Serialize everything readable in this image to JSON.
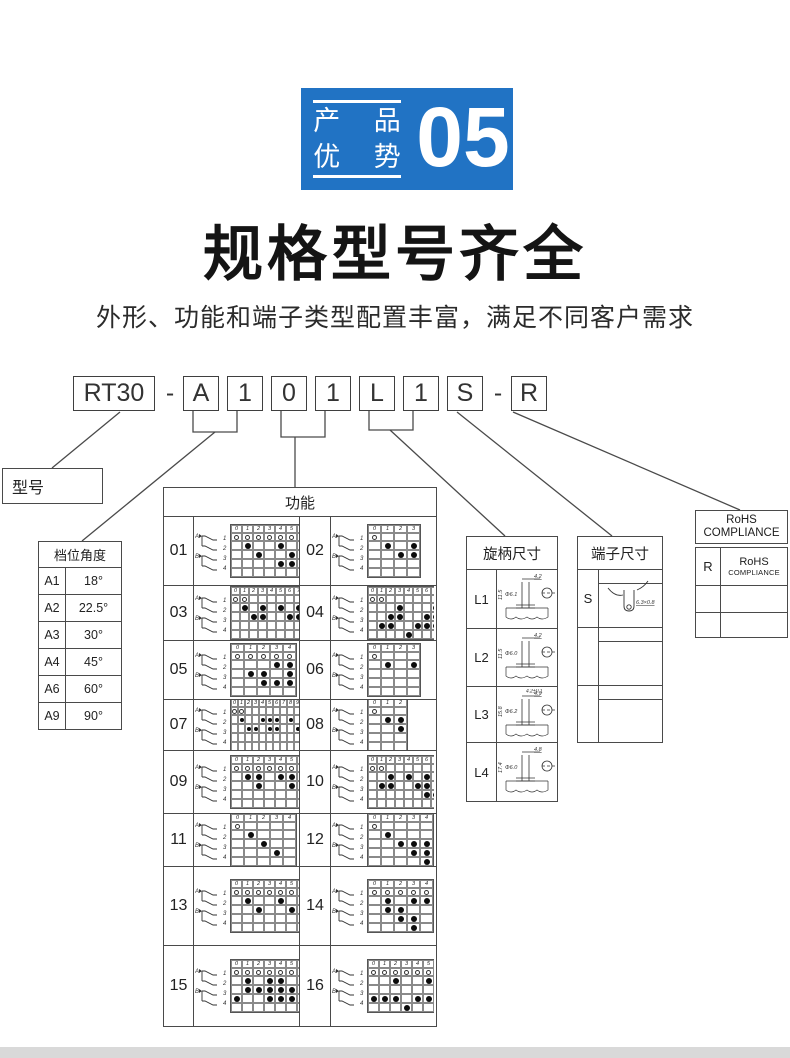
{
  "colors": {
    "accent_blue": "#2173c4",
    "line": "#4a4a4a",
    "footer_gray": "#d9d9d9"
  },
  "badge": {
    "line1": "产 品",
    "line2": "优 势",
    "number": "05"
  },
  "title": "规格型号齐全",
  "subtitle": "外形、功能和端子类型配置丰富，满足不同客户需求",
  "model_code": {
    "segments": [
      "RT30",
      "-",
      "A",
      "1",
      "0",
      "1",
      "L",
      "1",
      "S",
      "-",
      "R"
    ]
  },
  "model_label": "型号",
  "angle_table": {
    "title": "档位角度",
    "rows": [
      [
        "A1",
        "18°"
      ],
      [
        "A2",
        "22.5°"
      ],
      [
        "A3",
        "30°"
      ],
      [
        "A4",
        "45°"
      ],
      [
        "A6",
        "60°"
      ],
      [
        "A9",
        "90°"
      ]
    ]
  },
  "function_table": {
    "title": "功能",
    "cells": [
      {
        "no": "01",
        "cols": 7,
        "circles": [
          0,
          1,
          2,
          3,
          4,
          5,
          6
        ],
        "dots": [
          [
            1,
            1
          ],
          [
            1,
            4
          ],
          [
            2,
            2
          ],
          [
            2,
            5
          ],
          [
            3,
            4
          ],
          [
            3,
            5
          ]
        ]
      },
      {
        "no": "02",
        "cols": 4,
        "circles": [
          0
        ],
        "dots": [
          [
            1,
            1
          ],
          [
            1,
            3
          ],
          [
            2,
            2
          ],
          [
            2,
            3
          ]
        ]
      },
      {
        "no": "03",
        "cols": 9,
        "circles": [
          0,
          1
        ],
        "dots": [
          [
            1,
            1
          ],
          [
            1,
            3
          ],
          [
            1,
            5
          ],
          [
            1,
            7
          ],
          [
            2,
            2
          ],
          [
            2,
            3
          ],
          [
            2,
            6
          ],
          [
            2,
            7
          ]
        ]
      },
      {
        "no": "04",
        "cols": 9,
        "circles": [
          0,
          1
        ],
        "dots": [
          [
            1,
            3
          ],
          [
            1,
            7
          ],
          [
            2,
            2
          ],
          [
            2,
            3
          ],
          [
            2,
            6
          ],
          [
            2,
            7
          ],
          [
            3,
            1
          ],
          [
            3,
            2
          ],
          [
            3,
            5
          ],
          [
            3,
            6
          ],
          [
            3,
            7
          ],
          [
            4,
            4
          ]
        ]
      },
      {
        "no": "05",
        "cols": 5,
        "circles": [
          0,
          1,
          2,
          3,
          4
        ],
        "dots": [
          [
            1,
            3
          ],
          [
            1,
            4
          ],
          [
            2,
            1
          ],
          [
            2,
            2
          ],
          [
            2,
            4
          ],
          [
            3,
            2
          ],
          [
            3,
            3
          ],
          [
            3,
            4
          ]
        ]
      },
      {
        "no": "06",
        "cols": 4,
        "circles": [
          0
        ],
        "dots": [
          [
            1,
            1
          ],
          [
            1,
            3
          ]
        ]
      },
      {
        "no": "07",
        "cols": 13,
        "circles": [
          0,
          1
        ],
        "dots": [
          [
            1,
            1
          ],
          [
            1,
            4
          ],
          [
            1,
            5
          ],
          [
            1,
            6
          ],
          [
            1,
            8
          ],
          [
            1,
            10
          ],
          [
            1,
            11
          ],
          [
            2,
            2
          ],
          [
            2,
            3
          ],
          [
            2,
            5
          ],
          [
            2,
            6
          ],
          [
            2,
            9
          ],
          [
            2,
            10
          ],
          [
            2,
            11
          ],
          [
            2,
            12
          ]
        ]
      },
      {
        "no": "08",
        "cols": 3,
        "circles": [
          0
        ],
        "dots": [
          [
            1,
            1
          ],
          [
            1,
            2
          ],
          [
            2,
            2
          ]
        ]
      },
      {
        "no": "09",
        "cols": 7,
        "circles": [
          0,
          1,
          2,
          3,
          4,
          5,
          6
        ],
        "dots": [
          [
            1,
            1
          ],
          [
            1,
            2
          ],
          [
            1,
            4
          ],
          [
            1,
            5
          ],
          [
            2,
            2
          ],
          [
            2,
            5
          ]
        ]
      },
      {
        "no": "10",
        "cols": 9,
        "circles": [
          0,
          1
        ],
        "dots": [
          [
            1,
            2
          ],
          [
            1,
            4
          ],
          [
            1,
            6
          ],
          [
            2,
            1
          ],
          [
            2,
            2
          ],
          [
            2,
            5
          ],
          [
            2,
            6
          ],
          [
            3,
            6
          ],
          [
            3,
            7
          ]
        ]
      },
      {
        "no": "11",
        "cols": 5,
        "circles": [
          0
        ],
        "dots": [
          [
            1,
            1
          ],
          [
            2,
            2
          ],
          [
            3,
            3
          ]
        ]
      },
      {
        "no": "12",
        "cols": 5,
        "circles": [
          0
        ],
        "dots": [
          [
            1,
            1
          ],
          [
            2,
            2
          ],
          [
            2,
            3
          ],
          [
            2,
            4
          ],
          [
            3,
            3
          ],
          [
            3,
            4
          ],
          [
            4,
            4
          ]
        ]
      },
      {
        "no": "13",
        "cols": 7,
        "circles": [
          0,
          1,
          2,
          3,
          4,
          5,
          6
        ],
        "dots": [
          [
            1,
            1
          ],
          [
            1,
            4
          ],
          [
            2,
            2
          ],
          [
            2,
            5
          ]
        ]
      },
      {
        "no": "14",
        "cols": 5,
        "circles": [
          0,
          1,
          2,
          3,
          4
        ],
        "dots": [
          [
            1,
            1
          ],
          [
            1,
            3
          ],
          [
            1,
            4
          ],
          [
            2,
            1
          ],
          [
            2,
            2
          ],
          [
            3,
            2
          ],
          [
            3,
            3
          ],
          [
            4,
            3
          ]
        ]
      },
      {
        "no": "15",
        "cols": 7,
        "circles": [
          0,
          1,
          2,
          3,
          4,
          5,
          6
        ],
        "dots": [
          [
            1,
            1
          ],
          [
            1,
            3
          ],
          [
            1,
            4
          ],
          [
            2,
            1
          ],
          [
            2,
            2
          ],
          [
            2,
            3
          ],
          [
            2,
            4
          ],
          [
            2,
            5
          ],
          [
            2,
            6
          ],
          [
            3,
            0
          ],
          [
            3,
            3
          ],
          [
            3,
            4
          ],
          [
            3,
            5
          ]
        ]
      },
      {
        "no": "16",
        "cols": 7,
        "circles": [
          0,
          1,
          2,
          3,
          4,
          5,
          6
        ],
        "dots": [
          [
            1,
            2
          ],
          [
            1,
            5
          ],
          [
            1,
            6
          ],
          [
            2,
            6
          ],
          [
            3,
            0
          ],
          [
            3,
            1
          ],
          [
            3,
            2
          ],
          [
            3,
            4
          ],
          [
            3,
            5
          ],
          [
            3,
            6
          ],
          [
            4,
            3
          ]
        ]
      }
    ]
  },
  "knob_table": {
    "title": "旋柄尺寸",
    "rows": [
      {
        "label": "L1",
        "top_dim": "4.2",
        "dia_dim": "Φ6.1",
        "side_dim": "11.5"
      },
      {
        "label": "L2",
        "top_dim": "4.2",
        "dia_dim": "Φ6.0",
        "side_dim": "11.5"
      },
      {
        "label": "L3",
        "top_dim": "4.9",
        "dia_dim": "Φ6.2",
        "side_dim": "15.8",
        "extra_dim": "4.2±0.1"
      },
      {
        "label": "L4",
        "top_dim": "4.8",
        "dia_dim": "Φ6.0",
        "side_dim": "17.4"
      }
    ]
  },
  "terminal_table": {
    "title": "端子尺寸",
    "rows": [
      {
        "label": "S",
        "dim": "6.3×0.8"
      },
      {
        "label": "",
        "dim": ""
      },
      {
        "label": "",
        "dim": ""
      }
    ]
  },
  "rohs_table": {
    "header_line1": "RoHS",
    "header_line2": "COMPLIANCE",
    "rows": [
      {
        "code": "R",
        "label_line1": "RoHS",
        "label_line2": "COMPLIANCE"
      },
      {
        "code": "",
        "label_line1": "",
        "label_line2": ""
      },
      {
        "code": "",
        "label_line1": "",
        "label_line2": ""
      }
    ]
  }
}
